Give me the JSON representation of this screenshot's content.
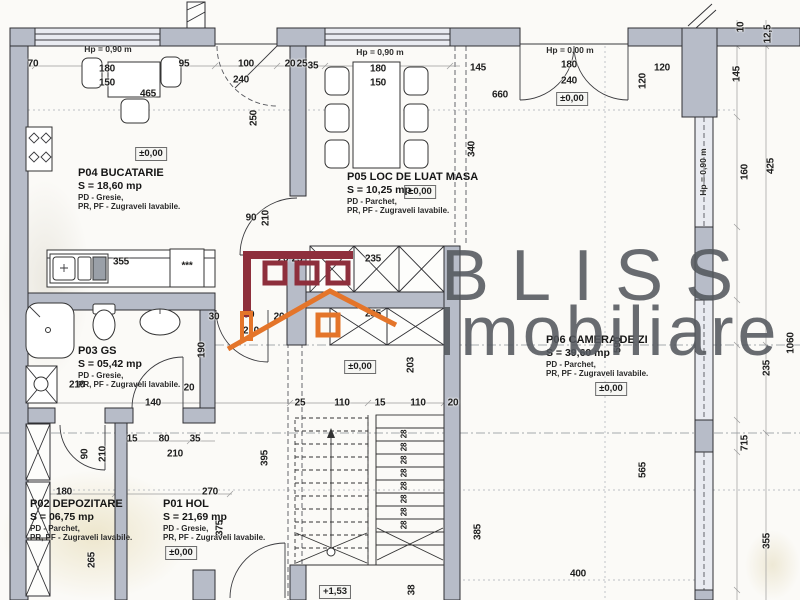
{
  "colors": {
    "wall_fill": "#b7bcc8",
    "window_fill": "#e9ebf1",
    "logo_red": "#8e2f3c",
    "logo_orange": "#e4752a",
    "watermark_text": "#54585e"
  },
  "watermark": {
    "line1": "BLISS",
    "line2": "Imobiliare"
  },
  "plan": {
    "rooms": [
      {
        "name": "P04 BUCATARIE",
        "area": "S = 18,60 mp",
        "finish_floor": "PD - Gresie,",
        "finish_walls": "PR, PF - Zugraveli lavabile.",
        "elevation": "±0,00"
      },
      {
        "name": "P05 LOC DE LUAT MASA",
        "area": "S = 10,25 mp",
        "finish_floor": "PD - Parchet,",
        "finish_walls": "PR, PF - Zugraveli lavabile.",
        "elevation": "±0,00"
      },
      {
        "name": "P06 CAMERA DE ZI",
        "area": "S = 39,60 mp",
        "finish_floor": "PD - Parchet,",
        "finish_walls": "PR, PF - Zugraveli lavabile.",
        "elevation": "±0,00"
      },
      {
        "name": "P03 GS",
        "area": "S = 05,42 mp",
        "finish_floor": "PD - Gresie,",
        "finish_walls": "PR, PF - Zugraveli lavabile."
      },
      {
        "name": "P02 DEPOZITARE",
        "area": "S = 06,75 mp",
        "finish_floor": "PD - Parchet,",
        "finish_walls": "PR, PF - Zugraveli lavabile."
      },
      {
        "name": "P01 HOL",
        "area": "S = 21,69 mp",
        "finish_floor": "PD - Gresie,",
        "finish_walls": "PR, PF - Zugraveli lavabile.",
        "elevation": "±0,00"
      }
    ],
    "height_labels": [
      {
        "text": "Hp = 0,90 m",
        "x": 108,
        "y": 49
      },
      {
        "text": "Hp = 0,90 m",
        "x": 380,
        "y": 52
      },
      {
        "text": "Hp = 0,00 m",
        "x": 570,
        "y": 50
      },
      {
        "text": "Hp = 0,90 m",
        "x": 703,
        "y": 172,
        "v": true
      }
    ],
    "elevation_markers": [
      {
        "label": "±0,00",
        "x": 151,
        "y": 154
      },
      {
        "label": "±0,00",
        "x": 420,
        "y": 192
      },
      {
        "label": "±0,00",
        "x": 572,
        "y": 99
      },
      {
        "label": "±0,00",
        "x": 360,
        "y": 367
      },
      {
        "label": "±0,00",
        "x": 611,
        "y": 389
      },
      {
        "label": "±0,00",
        "x": 181,
        "y": 553
      },
      {
        "label": "+1,53",
        "x": 335,
        "y": 592
      }
    ],
    "stairs": {
      "step_label": "28",
      "label_x": 404,
      "label_ys": [
        434,
        447,
        460,
        473,
        486,
        499,
        512,
        525
      ]
    },
    "dimensions": [
      {
        "t": "70",
        "x": 33,
        "y": 64
      },
      {
        "t": "180",
        "x": 107,
        "y": 69
      },
      {
        "t": "150",
        "x": 107,
        "y": 83
      },
      {
        "t": "95",
        "x": 184,
        "y": 64
      },
      {
        "t": "100",
        "x": 246,
        "y": 64
      },
      {
        "t": "240",
        "x": 241,
        "y": 80
      },
      {
        "t": "20",
        "x": 290,
        "y": 64
      },
      {
        "t": "25",
        "x": 302,
        "y": 64
      },
      {
        "t": "35",
        "x": 313,
        "y": 66
      },
      {
        "t": "180",
        "x": 378,
        "y": 69
      },
      {
        "t": "150",
        "x": 378,
        "y": 83
      },
      {
        "t": "145",
        "x": 478,
        "y": 68
      },
      {
        "t": "660",
        "x": 500,
        "y": 95
      },
      {
        "t": "180",
        "x": 569,
        "y": 65
      },
      {
        "t": "240",
        "x": 569,
        "y": 81
      },
      {
        "t": "120",
        "x": 662,
        "y": 68
      },
      {
        "t": "120",
        "x": 643,
        "y": 81,
        "v": true
      },
      {
        "t": "10",
        "x": 741,
        "y": 27,
        "v": true
      },
      {
        "t": "12,5",
        "x": 768,
        "y": 34,
        "v": true
      },
      {
        "t": "145",
        "x": 737,
        "y": 74,
        "v": true
      },
      {
        "t": "160",
        "x": 745,
        "y": 172,
        "v": true
      },
      {
        "t": "425",
        "x": 771,
        "y": 166,
        "v": true
      },
      {
        "t": "465",
        "x": 148,
        "y": 94
      },
      {
        "t": "250",
        "x": 254,
        "y": 118,
        "v": true
      },
      {
        "t": "90",
        "x": 251,
        "y": 218
      },
      {
        "t": "210",
        "x": 266,
        "y": 218,
        "v": true
      },
      {
        "t": "355",
        "x": 121,
        "y": 262
      },
      {
        "t": "***",
        "x": 187,
        "y": 266
      },
      {
        "t": "30",
        "x": 214,
        "y": 317
      },
      {
        "t": "90",
        "x": 249,
        "y": 315
      },
      {
        "t": "210",
        "x": 251,
        "y": 331
      },
      {
        "t": "20",
        "x": 279,
        "y": 317
      },
      {
        "t": "190",
        "x": 202,
        "y": 350,
        "v": true
      },
      {
        "t": "20",
        "x": 283,
        "y": 259
      },
      {
        "t": "25",
        "x": 297,
        "y": 259
      },
      {
        "t": "235",
        "x": 373,
        "y": 259
      },
      {
        "t": "235",
        "x": 373,
        "y": 314
      },
      {
        "t": "203",
        "x": 411,
        "y": 365,
        "v": true
      },
      {
        "t": "340",
        "x": 472,
        "y": 149,
        "v": true
      },
      {
        "t": "590",
        "x": 618,
        "y": 345,
        "v": true
      },
      {
        "t": "1060",
        "x": 791,
        "y": 343,
        "v": true
      },
      {
        "t": "235",
        "x": 767,
        "y": 368,
        "v": true
      },
      {
        "t": "715",
        "x": 745,
        "y": 443,
        "v": true
      },
      {
        "t": "355",
        "x": 767,
        "y": 541,
        "v": true
      },
      {
        "t": "565",
        "x": 643,
        "y": 470,
        "v": true
      },
      {
        "t": "140",
        "x": 153,
        "y": 403
      },
      {
        "t": "25",
        "x": 300,
        "y": 403
      },
      {
        "t": "110",
        "x": 342,
        "y": 403
      },
      {
        "t": "15",
        "x": 380,
        "y": 403
      },
      {
        "t": "110",
        "x": 418,
        "y": 403
      },
      {
        "t": "20",
        "x": 453,
        "y": 403
      },
      {
        "t": "395",
        "x": 265,
        "y": 458,
        "v": true
      },
      {
        "t": "385",
        "x": 478,
        "y": 532,
        "v": true
      },
      {
        "t": "15",
        "x": 132,
        "y": 439
      },
      {
        "t": "80",
        "x": 164,
        "y": 439
      },
      {
        "t": "35",
        "x": 195,
        "y": 439
      },
      {
        "t": "210",
        "x": 175,
        "y": 454
      },
      {
        "t": "90",
        "x": 85,
        "y": 454,
        "v": true
      },
      {
        "t": "210",
        "x": 103,
        "y": 454,
        "v": true
      },
      {
        "t": "180",
        "x": 64,
        "y": 492
      },
      {
        "t": "270",
        "x": 210,
        "y": 492
      },
      {
        "t": "265",
        "x": 92,
        "y": 560,
        "v": true
      },
      {
        "t": "375",
        "x": 220,
        "y": 528,
        "v": true
      },
      {
        "t": "400",
        "x": 578,
        "y": 574
      },
      {
        "t": "38",
        "x": 412,
        "y": 590,
        "v": true
      },
      {
        "t": "20",
        "x": 189,
        "y": 388
      },
      {
        "t": "210",
        "x": 77,
        "y": 385
      }
    ]
  }
}
